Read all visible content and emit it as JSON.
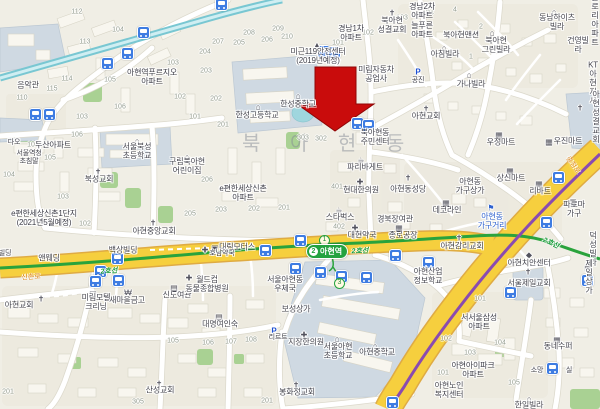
{
  "map": {
    "watermark": "북 아 현 동",
    "station": {
      "name": "아현역",
      "badge": "2",
      "exits": [
        {
          "n": "1",
          "x": 324,
          "y": 240
        },
        {
          "n": "3",
          "x": 339,
          "y": 283
        }
      ]
    },
    "road_labels": [
      {
        "t": "신촌로",
        "x": 31,
        "y": 277,
        "rot": -4
      },
      {
        "t": "충정로",
        "x": 573,
        "y": 165,
        "rot": 55
      }
    ],
    "line_labels": [
      {
        "t": "2호선",
        "x": 109,
        "y": 271,
        "rot": -4
      },
      {
        "t": "2호선",
        "x": 360,
        "y": 251,
        "rot": -2
      },
      {
        "t": "2호선",
        "x": 551,
        "y": 243,
        "rot": 24
      }
    ],
    "labels": [
      {
        "t": "음악관",
        "x": 28,
        "y": 86
      },
      {
        "t": "아현역푸르지오\n아파트",
        "x": 152,
        "y": 78,
        "c": "area"
      },
      {
        "t": "다오",
        "x": 14,
        "y": 143,
        "c": "sm"
      },
      {
        "t": "서울역청\n초침말",
        "x": 29,
        "y": 158,
        "c": "sm"
      },
      {
        "t": "두산아파트",
        "x": 53,
        "y": 146,
        "c": "area"
      },
      {
        "t": "서울북성\n초등학교",
        "x": 137,
        "y": 152
      },
      {
        "t": "북성교회",
        "x": 99,
        "y": 180
      },
      {
        "t": "구립북아현\n어린이집",
        "x": 187,
        "y": 167
      },
      {
        "t": "e편한세상신촌1단지\n(2021년5월예정)",
        "x": 44,
        "y": 219,
        "c": "area"
      },
      {
        "t": "아현중앙교회",
        "x": 154,
        "y": 232
      },
      {
        "t": "e편한세상신촌\n아파트",
        "x": 243,
        "y": 194,
        "c": "area"
      },
      {
        "t": "대림모터스",
        "x": 237,
        "y": 248
      },
      {
        "t": "호남약국",
        "x": 222,
        "y": 254,
        "c": "sm"
      },
      {
        "t": "백상빌딩",
        "x": 123,
        "y": 251
      },
      {
        "t": "앤웨딩",
        "x": 49,
        "y": 259
      },
      {
        "t": "빌딩",
        "x": 5,
        "y": 254,
        "c": "sm"
      },
      {
        "t": "미림모텔\n크리닝",
        "x": 96,
        "y": 303
      },
      {
        "t": "새마을금고",
        "x": 127,
        "y": 301
      },
      {
        "t": "신도여관",
        "x": 177,
        "y": 296
      },
      {
        "t": "월드컵\n동물종합병원",
        "x": 207,
        "y": 285
      },
      {
        "t": "서울아현동\n우체국",
        "x": 285,
        "y": 285
      },
      {
        "t": "보성상가",
        "x": 296,
        "y": 310
      },
      {
        "t": "아현교회",
        "x": 19,
        "y": 306
      },
      {
        "t": "산성교회",
        "x": 160,
        "y": 391
      },
      {
        "t": "대명여인숙",
        "x": 220,
        "y": 325
      },
      {
        "t": "지장한의원",
        "x": 306,
        "y": 343
      },
      {
        "t": "리르트",
        "x": 278,
        "y": 338,
        "c": "sm"
      },
      {
        "t": "봉화정교회",
        "x": 297,
        "y": 393
      },
      {
        "t": "서울아현\n초등학교",
        "x": 338,
        "y": 352
      },
      {
        "t": "아현중학교",
        "x": 377,
        "y": 353
      },
      {
        "t": "아현산업\n정보학교",
        "x": 428,
        "y": 277
      },
      {
        "t": "아현노인\n복지센터",
        "x": 449,
        "y": 391
      },
      {
        "t": "한일빌라",
        "x": 529,
        "y": 406
      },
      {
        "t": "한성중학교",
        "x": 298,
        "y": 105
      },
      {
        "t": "한성고등학교",
        "x": 257,
        "y": 116
      },
      {
        "t": "미근119안전센터\n(2019년예정)",
        "x": 318,
        "y": 57
      },
      {
        "t": "경남1차\n아파트",
        "x": 351,
        "y": 34,
        "c": "area"
      },
      {
        "t": "북아현동\n주민센터",
        "x": 375,
        "y": 138
      },
      {
        "t": "파리바게트",
        "x": 365,
        "y": 168
      },
      {
        "t": "현대한의원",
        "x": 361,
        "y": 191
      },
      {
        "t": "스타벅스",
        "x": 340,
        "y": 218
      },
      {
        "t": "경북장여관",
        "x": 395,
        "y": 220
      },
      {
        "t": "대현약국",
        "x": 362,
        "y": 236
      },
      {
        "t": "종로공장",
        "x": 403,
        "y": 236
      },
      {
        "t": "아현동성당",
        "x": 408,
        "y": 190
      },
      {
        "t": "아현교회",
        "x": 426,
        "y": 117
      },
      {
        "t": "미림자동차\n공업사",
        "x": 376,
        "y": 75
      },
      {
        "t": "북아현\n성결교회",
        "x": 392,
        "y": 26
      },
      {
        "t": "경남2차\n아파트",
        "x": 422,
        "y": 12,
        "c": "area"
      },
      {
        "t": "늘푸른\n아파트",
        "x": 422,
        "y": 31,
        "c": "area"
      },
      {
        "t": "북아현맨션",
        "x": 461,
        "y": 36
      },
      {
        "t": "북아현\n그린빌라",
        "x": 496,
        "y": 46
      },
      {
        "t": "아침빌라",
        "x": 445,
        "y": 55
      },
      {
        "t": "공진",
        "x": 418,
        "y": 81,
        "c": "sm"
      },
      {
        "t": "가나빌라",
        "x": 471,
        "y": 85
      },
      {
        "t": "동남하이츠\n빌라",
        "x": 557,
        "y": 23
      },
      {
        "t": "글로리\n아파트",
        "x": 595,
        "y": 21,
        "c": "area"
      },
      {
        "t": "건영빌라",
        "x": 578,
        "y": 46
      },
      {
        "t": "KT아현지사",
        "x": 593,
        "y": 84
      },
      {
        "t": "아현성결교회",
        "x": 596,
        "y": 118
      },
      {
        "t": "우정마트",
        "x": 501,
        "y": 143
      },
      {
        "t": "우진마트",
        "x": 568,
        "y": 142
      },
      {
        "t": "상신마트",
        "x": 511,
        "y": 179
      },
      {
        "t": "아현동\n가구상가",
        "x": 470,
        "y": 187
      },
      {
        "t": "리바트",
        "x": 540,
        "y": 192
      },
      {
        "t": "데코라인",
        "x": 447,
        "y": 211
      },
      {
        "t": "아현동\n가구거리",
        "x": 492,
        "y": 222,
        "c": "blue"
      },
      {
        "t": "파로마가구",
        "x": 574,
        "y": 210
      },
      {
        "t": "아현감리교회",
        "x": 462,
        "y": 247
      },
      {
        "t": "덕성빌라",
        "x": 593,
        "y": 250
      },
      {
        "t": "아현치안센터",
        "x": 529,
        "y": 264
      },
      {
        "t": "서울제일교회",
        "x": 529,
        "y": 284
      },
      {
        "t": "제일상가",
        "x": 589,
        "y": 278
      },
      {
        "t": "서서울삼성\n아파트",
        "x": 479,
        "y": 323,
        "c": "area"
      },
      {
        "t": "아현아이파크\n아파트",
        "x": 473,
        "y": 371,
        "c": "area"
      },
      {
        "t": "동네수퍼",
        "x": 558,
        "y": 347
      },
      {
        "t": "소망",
        "x": 537,
        "y": 371,
        "c": "sm"
      },
      {
        "t": "실",
        "x": 569,
        "y": 371,
        "c": "sm"
      }
    ],
    "icons": [
      {
        "k": "school",
        "x": 137,
        "y": 141
      },
      {
        "k": "church",
        "x": 98,
        "y": 172
      },
      {
        "k": "school",
        "x": 187,
        "y": 157
      },
      {
        "k": "church",
        "x": 153,
        "y": 223
      },
      {
        "k": "car",
        "x": 215,
        "y": 248
      },
      {
        "k": "hospital",
        "x": 205,
        "y": 250
      },
      {
        "k": "motel",
        "x": 93,
        "y": 294
      },
      {
        "k": "bank",
        "x": 128,
        "y": 293
      },
      {
        "k": "motel",
        "x": 174,
        "y": 288
      },
      {
        "k": "hospital",
        "x": 189,
        "y": 278
      },
      {
        "k": "church",
        "x": 41,
        "y": 299
      },
      {
        "k": "church",
        "x": 159,
        "y": 384
      },
      {
        "k": "motel",
        "x": 219,
        "y": 317
      },
      {
        "k": "hospital",
        "x": 304,
        "y": 335
      },
      {
        "k": "parking",
        "x": 274,
        "y": 331
      },
      {
        "k": "church",
        "x": 296,
        "y": 385
      },
      {
        "k": "school",
        "x": 337,
        "y": 339
      },
      {
        "k": "school",
        "x": 375,
        "y": 346
      },
      {
        "k": "villa",
        "x": 529,
        "y": 399
      },
      {
        "k": "school",
        "x": 298,
        "y": 96
      },
      {
        "k": "school",
        "x": 258,
        "y": 107
      },
      {
        "k": "fire",
        "x": 317,
        "y": 45
      },
      {
        "k": "cafe",
        "x": 361,
        "y": 160
      },
      {
        "k": "hospital",
        "x": 360,
        "y": 182
      },
      {
        "k": "cafe",
        "x": 339,
        "y": 210
      },
      {
        "k": "hospital",
        "x": 355,
        "y": 228
      },
      {
        "k": "mart",
        "x": 399,
        "y": 228
      },
      {
        "k": "church",
        "x": 408,
        "y": 178
      },
      {
        "k": "church",
        "x": 426,
        "y": 109
      },
      {
        "k": "church",
        "x": 392,
        "y": 13
      },
      {
        "k": "villa",
        "x": 492,
        "y": 33
      },
      {
        "k": "villa",
        "x": 444,
        "y": 48
      },
      {
        "k": "parking",
        "x": 418,
        "y": 72
      },
      {
        "k": "villa",
        "x": 469,
        "y": 75
      },
      {
        "k": "villa",
        "x": 554,
        "y": 12
      },
      {
        "k": "church",
        "x": 580,
        "y": 108
      },
      {
        "k": "mart",
        "x": 499,
        "y": 135
      },
      {
        "k": "mart",
        "x": 549,
        "y": 142
      },
      {
        "k": "mart",
        "x": 510,
        "y": 171
      },
      {
        "k": "furniture",
        "x": 539,
        "y": 184
      },
      {
        "k": "furniture",
        "x": 446,
        "y": 203
      },
      {
        "k": "flag",
        "x": 491,
        "y": 208
      },
      {
        "k": "furniture",
        "x": 573,
        "y": 202
      },
      {
        "k": "church",
        "x": 459,
        "y": 238
      },
      {
        "k": "villa",
        "x": 594,
        "y": 241
      },
      {
        "k": "police",
        "x": 529,
        "y": 255
      },
      {
        "k": "church",
        "x": 528,
        "y": 272
      },
      {
        "k": "mart",
        "x": 588,
        "y": 268
      },
      {
        "k": "mart",
        "x": 557,
        "y": 340
      }
    ],
    "numbers": [
      {
        "t": "112",
        "x": 77,
        "y": 12
      },
      {
        "t": "104",
        "x": 118,
        "y": 30
      },
      {
        "t": "113",
        "x": 85,
        "y": 42
      },
      {
        "t": "114",
        "x": 67,
        "y": 79
      },
      {
        "t": "115",
        "x": 52,
        "y": 89
      },
      {
        "t": "110",
        "x": 22,
        "y": 98
      },
      {
        "t": "105",
        "x": 110,
        "y": 80
      },
      {
        "t": "106",
        "x": 120,
        "y": 107
      },
      {
        "t": "103",
        "x": 82,
        "y": 117
      },
      {
        "t": "103",
        "x": 173,
        "y": 63
      },
      {
        "t": "102",
        "x": 180,
        "y": 97
      },
      {
        "t": "101",
        "x": 195,
        "y": 117
      },
      {
        "t": "101",
        "x": 33,
        "y": 145
      },
      {
        "t": "105",
        "x": 50,
        "y": 158
      },
      {
        "t": "104",
        "x": 9,
        "y": 175
      },
      {
        "t": "103",
        "x": 63,
        "y": 197
      },
      {
        "t": "102",
        "x": 85,
        "y": 224
      },
      {
        "t": "106",
        "x": 77,
        "y": 135
      },
      {
        "t": "207",
        "x": 218,
        "y": 42
      },
      {
        "t": "204",
        "x": 205,
        "y": 52
      },
      {
        "t": "205",
        "x": 239,
        "y": 43
      },
      {
        "t": "208",
        "x": 249,
        "y": 33
      },
      {
        "t": "206",
        "x": 267,
        "y": 40
      },
      {
        "t": "209",
        "x": 278,
        "y": 29
      },
      {
        "t": "210",
        "x": 287,
        "y": 37
      },
      {
        "t": "203",
        "x": 206,
        "y": 71
      },
      {
        "t": "202",
        "x": 216,
        "y": 99
      },
      {
        "t": "201",
        "x": 223,
        "y": 125
      },
      {
        "t": "103",
        "x": 402,
        "y": 18
      },
      {
        "t": "104",
        "x": 428,
        "y": 13
      },
      {
        "t": "101",
        "x": 338,
        "y": 43
      },
      {
        "t": "102",
        "x": 368,
        "y": 33
      },
      {
        "t": "303",
        "x": 303,
        "y": 138
      },
      {
        "t": "302",
        "x": 321,
        "y": 139
      },
      {
        "t": "206",
        "x": 207,
        "y": 180
      },
      {
        "t": "205",
        "x": 190,
        "y": 214
      },
      {
        "t": "203",
        "x": 221,
        "y": 210
      },
      {
        "t": "202",
        "x": 254,
        "y": 209
      },
      {
        "t": "201",
        "x": 284,
        "y": 208
      },
      {
        "t": "401",
        "x": 337,
        "y": 187
      },
      {
        "t": "402",
        "x": 339,
        "y": 227
      },
      {
        "t": "101",
        "x": 480,
        "y": 299
      },
      {
        "t": "102",
        "x": 446,
        "y": 339
      },
      {
        "t": "103",
        "x": 470,
        "y": 353
      },
      {
        "t": "104",
        "x": 500,
        "y": 343
      },
      {
        "t": "105",
        "x": 514,
        "y": 383
      },
      {
        "t": "101",
        "x": 443,
        "y": 373
      },
      {
        "t": "105",
        "x": 173,
        "y": 341
      },
      {
        "t": "106",
        "x": 208,
        "y": 343
      },
      {
        "t": "107",
        "x": 231,
        "y": 342
      },
      {
        "t": "108",
        "x": 251,
        "y": 340
      },
      {
        "t": "201",
        "x": 267,
        "y": 401
      },
      {
        "t": "305",
        "x": 138,
        "y": 402
      },
      {
        "t": "201",
        "x": 8,
        "y": 392
      },
      {
        "t": "1",
        "x": 471,
        "y": 57
      },
      {
        "t": "2",
        "x": 481,
        "y": 27
      },
      {
        "t": "4",
        "x": 455,
        "y": 10
      }
    ],
    "buses": [
      [
        143,
        32
      ],
      [
        127,
        53
      ],
      [
        107,
        63
      ],
      [
        35,
        114
      ],
      [
        49,
        114
      ],
      [
        221,
        4
      ],
      [
        323,
        51
      ],
      [
        334,
        52
      ],
      [
        357,
        123
      ],
      [
        368,
        125
      ],
      [
        300,
        240
      ],
      [
        265,
        250
      ],
      [
        295,
        268
      ],
      [
        320,
        272
      ],
      [
        341,
        276
      ],
      [
        366,
        277
      ],
      [
        395,
        255
      ],
      [
        428,
        262
      ],
      [
        117,
        258
      ],
      [
        100,
        271
      ],
      [
        95,
        281
      ],
      [
        118,
        280
      ],
      [
        558,
        177
      ],
      [
        546,
        222
      ],
      [
        510,
        292
      ],
      [
        587,
        280
      ],
      [
        552,
        368
      ],
      [
        392,
        402
      ]
    ],
    "colors": {
      "line2_green": "#2aa33c",
      "line5_purple": "#8a4bb0",
      "main_road_yellow": "#f6cf3e",
      "rail_teal": "#79c7d2",
      "arrow_red": "#c90c0c",
      "bus_blue": "#3e7ce2"
    }
  }
}
